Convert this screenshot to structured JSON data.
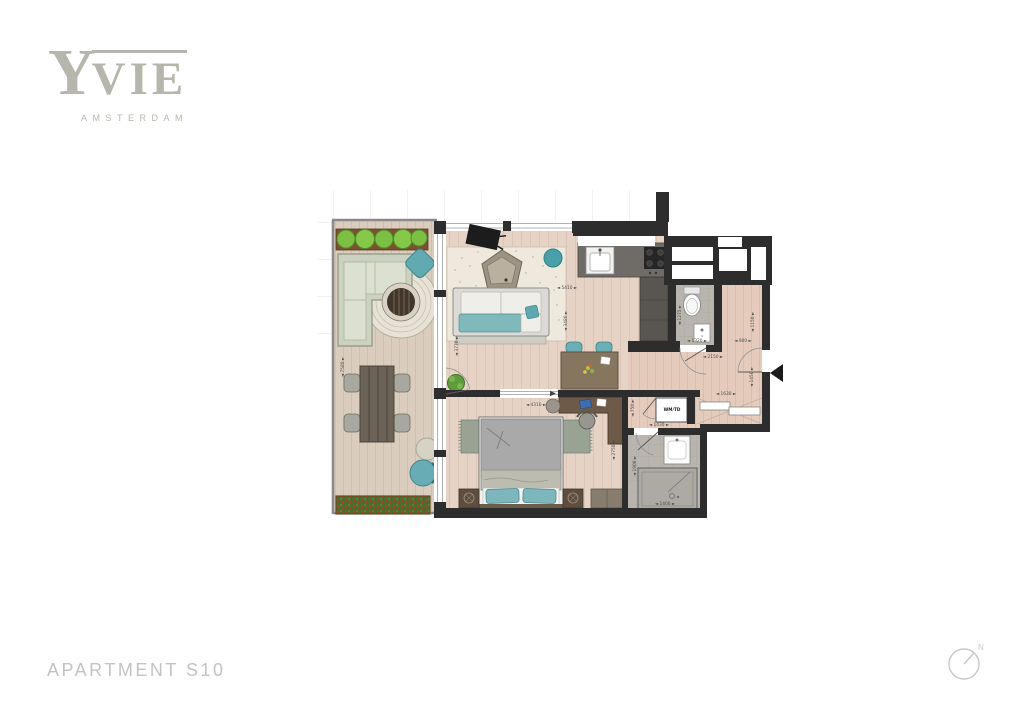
{
  "brand": {
    "logo_y": "Y",
    "logo_rest": "VIE",
    "logo_sub": "AMSTERDAM"
  },
  "footer": {
    "apartment_label": "APARTMENT S10"
  },
  "compass": {
    "north_label": "N"
  },
  "floorplan": {
    "closet_label": "WM/TD",
    "dimensions": [
      {
        "value": "7580",
        "x": 344,
        "y": 367,
        "o": "v"
      },
      {
        "value": "5410",
        "x": 567,
        "y": 289,
        "o": "h"
      },
      {
        "value": "3480",
        "x": 567,
        "y": 321,
        "o": "v"
      },
      {
        "value": "3770",
        "x": 458,
        "y": 346,
        "o": "v"
      },
      {
        "value": "4310",
        "x": 536,
        "y": 406,
        "o": "h"
      },
      {
        "value": "2750",
        "x": 615,
        "y": 450,
        "o": "v"
      },
      {
        "value": "1275",
        "x": 681,
        "y": 315,
        "o": "v"
      },
      {
        "value": "1320",
        "x": 697,
        "y": 342,
        "o": "h"
      },
      {
        "value": "1150",
        "x": 754,
        "y": 322,
        "o": "v"
      },
      {
        "value": "900",
        "x": 743,
        "y": 342,
        "o": "h"
      },
      {
        "value": "2150",
        "x": 713,
        "y": 358,
        "o": "h"
      },
      {
        "value": "1450",
        "x": 753,
        "y": 377,
        "o": "v"
      },
      {
        "value": "1630",
        "x": 726,
        "y": 395,
        "o": "h"
      },
      {
        "value": "750",
        "x": 634,
        "y": 408,
        "o": "v"
      },
      {
        "value": "1430",
        "x": 659,
        "y": 426,
        "o": "h"
      },
      {
        "value": "1900",
        "x": 636,
        "y": 466,
        "o": "v"
      },
      {
        "value": "1400",
        "x": 665,
        "y": 505,
        "o": "h"
      }
    ]
  },
  "colors": {
    "brand_gray": "#b6b6ac",
    "footer_gray": "#c3c3c3",
    "wall": "#2d2d2d",
    "accent_teal": "#64a9b1",
    "wood_living": "#e7d3c5",
    "wood_terrace": "#dacdbd",
    "tile_gray": "#b9b5ae",
    "plant_green": "#7cc043",
    "sofa_sage": "#ccd2c0"
  }
}
